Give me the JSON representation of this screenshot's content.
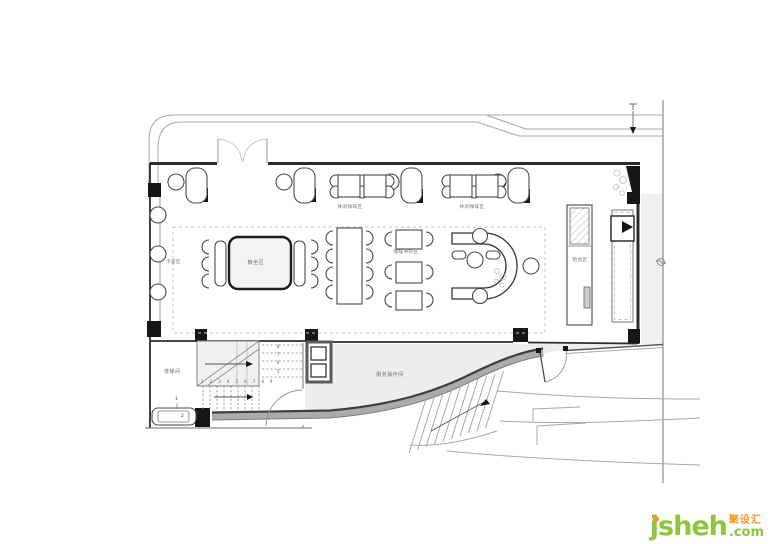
{
  "labels": {
    "leisure_coffee_a": "休闲咖啡区",
    "leisure_coffee_b": "休闲咖啡区",
    "booth_seating": "卡座区",
    "open_seating": "散坐区",
    "coffee_book_bar": "咖啡书吧区",
    "bar_counter": "吧台区",
    "stair_room": "楼梯间",
    "service_room": "服务操作间"
  },
  "stair_annotations": {
    "lower_tread_numbers": [
      "1",
      "2",
      "3",
      "4",
      "5",
      "6",
      "7",
      "8",
      "9"
    ],
    "upper_tread_numbers": [
      "8",
      "7",
      "6",
      "5"
    ],
    "bench_callout_1": "1",
    "bench_callout_2": "2"
  },
  "watermark": {
    "brand": "jsheh",
    "suffix": ".com",
    "cn_name": "聚设汇"
  },
  "colors": {
    "wm_green": "#8cc63e",
    "wm_orange": "#f7941e",
    "wall": "#2b2b2b",
    "fill_light": "#ededed"
  }
}
